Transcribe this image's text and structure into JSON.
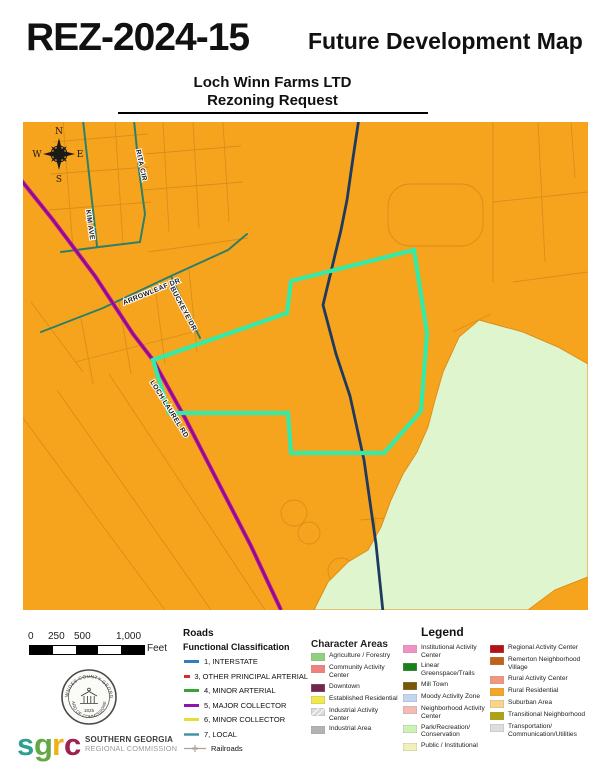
{
  "header": {
    "case_number": "REZ-2024-15",
    "title": "Future Development Map",
    "subtitle_line1": "Loch Winn Farms LTD",
    "subtitle_line2": "Rezoning Request"
  },
  "map": {
    "colors": {
      "background": "#F6A41E",
      "parcel_line": "#D98E1A",
      "conservation": "#DFF5CE",
      "subject_outline": "#35E9A6",
      "local_road": "#2E7F68",
      "major_collector": "#C0139F",
      "major_collector_core": "#850C8C",
      "navy_road": "#1E3B5F"
    },
    "road_labels": {
      "kim_ave": "KIM AVE",
      "rita_cir": "RITA CIR",
      "arrowleaf": "ARROWLEAF DR",
      "buckeye": "BUCKEYE DR",
      "loch_laurel": "LOCH LAUREL RD"
    },
    "compass": {
      "north": "N",
      "east": "E",
      "south": "S",
      "west": "W"
    }
  },
  "scalebar": {
    "labels": [
      "0",
      "250",
      "500",
      "1,000"
    ],
    "unit": "Feet"
  },
  "seal": {
    "top_text": "LOWNDES COUNTY GEORGIA",
    "bottom_text": "BOARD OF COMMISSIONERS",
    "year": "1825"
  },
  "sgrc": {
    "letters": [
      {
        "char": "s",
        "color": "#2D9E8F"
      },
      {
        "char": "g",
        "color": "#63A845"
      },
      {
        "char": "r",
        "color": "#EFB118"
      },
      {
        "char": "c",
        "color": "#9E2150"
      }
    ],
    "name_line1": "SOUTHERN GEORGIA",
    "name_line2": "REGIONAL COMMISSION"
  },
  "roads_legend": {
    "heading": "Roads",
    "subheading": "Functional Classification",
    "items": [
      {
        "label": "1, INTERSTATE",
        "color": "#2E7EC2"
      },
      {
        "label": "3, OTHER PRINCIPAL ARTERIAL",
        "color": "#D92B26"
      },
      {
        "label": "4, MINOR ARTERIAL",
        "color": "#3AA336"
      },
      {
        "label": "5, MAJOR COLLECTOR",
        "color": "#9012B5"
      },
      {
        "label": "6, MINOR COLLECTOR",
        "color": "#E3DE3A"
      },
      {
        "label": "7, LOCAL",
        "color": "#3E8FA8"
      },
      {
        "label": "Railroads",
        "color": "#ABA394"
      }
    ]
  },
  "legend": {
    "title": "Legend",
    "character_heading": "Character Areas",
    "columns": [
      [
        {
          "label": "Agriculture / Forestry",
          "color": "#8FD17E"
        },
        {
          "label": "Community Activity Center",
          "color": "#F0827D"
        },
        {
          "label": "Downtown",
          "color": "#73264D"
        },
        {
          "label": "Established Residential",
          "color": "#F0E94C"
        },
        {
          "label": "Industrial Activity Center",
          "color": "#D9D9D9"
        },
        {
          "label": "Industrial Area",
          "color": "#B3B3B3"
        }
      ],
      [
        {
          "label": "Institutional Activity Center",
          "color": "#F291C4"
        },
        {
          "label": "Linear Greenspace/Trails",
          "color": "#1A801A"
        },
        {
          "label": "Mill Town",
          "color": "#7A5608"
        },
        {
          "label": "Moody Activity Zone",
          "color": "#C2D6F2"
        },
        {
          "label": "Neighborhood Activity Center",
          "color": "#F2BCB4"
        },
        {
          "label": "Park/Recreation/ Conservation",
          "color": "#CCF2B8"
        },
        {
          "label": "Public / Institutional",
          "color": "#F2F0B8"
        }
      ],
      [
        {
          "label": "Regional Activity Center",
          "color": "#B31217"
        },
        {
          "label": "Remerton Neighborhood Village",
          "color": "#C2611A"
        },
        {
          "label": "Rural Activity Center",
          "color": "#F2967D"
        },
        {
          "label": "Rural Residential",
          "color": "#F5A623"
        },
        {
          "label": "Suburban Area",
          "color": "#FAD489"
        },
        {
          "label": "Transitional Neighborhood",
          "color": "#ABA40F"
        },
        {
          "label": "Transportation/ Communication/Utilities",
          "color": "#DEDEDE"
        }
      ]
    ]
  }
}
